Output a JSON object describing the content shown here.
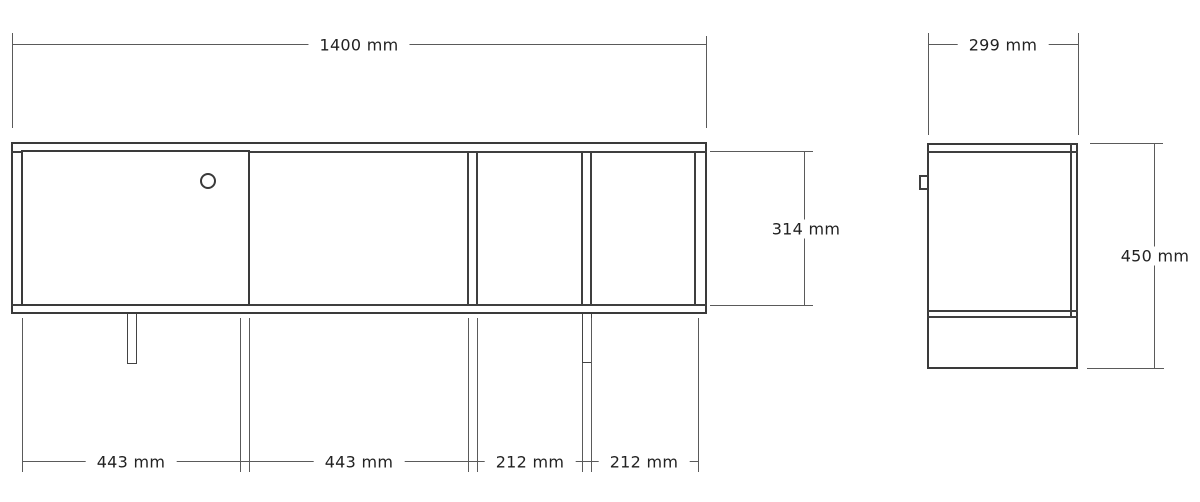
{
  "front_view": {
    "width_label": "1400 mm",
    "height_label": "314 mm",
    "sections": [
      "443 mm",
      "443 mm",
      "212 mm",
      "212 mm"
    ]
  },
  "side_view": {
    "width_label": "299 mm",
    "height_label": "450 mm"
  },
  "colors": {
    "line": "#3f3f3f",
    "dim_line": "#5a5a5a",
    "text": "#222222",
    "background": "#ffffff"
  }
}
